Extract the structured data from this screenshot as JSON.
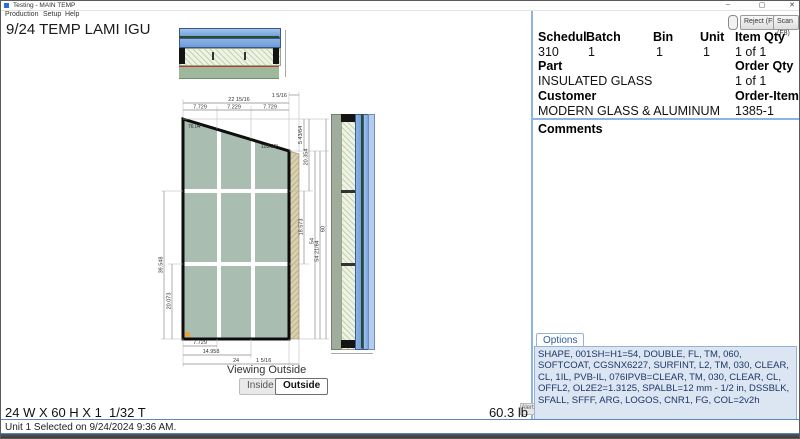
{
  "window": {
    "title": "Testing - MAIN TEMP",
    "minimize": "–",
    "maximize": "▢",
    "close": "✕"
  },
  "menu": {
    "items": [
      "Production",
      "Setup",
      "Help"
    ]
  },
  "toolbar": {
    "reject_label": "Reject (F5)",
    "scan_label": "Scan (F8)"
  },
  "drawing": {
    "title": "9/24 TEMP LAMI IGU",
    "viewing_label": "Viewing Outside",
    "inside_label": "Inside",
    "outside_label": "Outside",
    "angles": {
      "top_left": "76.04°",
      "top_right": "103.96°"
    },
    "dims": {
      "top_strip": "1 5/16",
      "top_total": "22 15/16",
      "top_seg1": "7.729",
      "top_seg2": "7.229",
      "top_seg3": "7.729",
      "right_drop": "5 43/64",
      "right_sec1": "20.354",
      "right_sec2": "18.573",
      "right_glass_height": "54",
      "right_edge_height": "54 21/64",
      "overall_height": "60",
      "left_span": "39.548",
      "left_bottom": "20.073",
      "bottom_seg": "7.729",
      "bottom_mid": "14.958",
      "bottom_total": "24",
      "bottom_strip": "1 5/16"
    }
  },
  "info": {
    "headers": {
      "schedule": "Schedul",
      "batch": "Batch",
      "bin": "Bin",
      "unit": "Unit",
      "item_qty": "Item Qty",
      "part": "Part",
      "order_qty": "Order Qty",
      "customer": "Customer",
      "order_item": "Order-Item"
    },
    "values": {
      "schedule": "310",
      "batch": "1",
      "bin": "1",
      "unit": "1",
      "item_qty": "1 of 1",
      "part": "INSULATED GLASS",
      "order_qty": "1 of 1",
      "customer": "MODERN GLASS & ALUMINUM",
      "order_item": "1385-1"
    }
  },
  "comments": {
    "label": "Comments"
  },
  "options": {
    "tab_label": "Options",
    "alerts_label": "Alerts",
    "text": "SHAPE, 001SH=H1=54, DOUBLE, FL, TM, 060, SOFTCOAT, CGSNX6227, SURFINT, L2, TM, 030, CLEAR, CL, 1IL, PVB-IL, 076IPVB=CLEAR, TM, 030, CLEAR, CL, OFFL2, OL2E2=1.3125, SPALBL=12 mm - 1/2 in, DSSBLK, SFALL, SFFF, ARG, LOGOS, CNR1, FG, COL=2v2h"
  },
  "status": {
    "size": "24 W X 60 H X 1  1/32 T",
    "weight": "60.3 lb",
    "message": "Unit 1 Selected on 9/24/2024 9:36 AM."
  },
  "colors": {
    "panel_divider": "#8eb4e3",
    "options_bg": "#dce6f2",
    "options_text": "#1c3667",
    "options_border": "#95b3d7",
    "glass_fill": "#a9bdb1",
    "glass_blue": "#7aa3dd",
    "lami_green": "#9fae9c",
    "edge_tan": "#d8d0b0",
    "corner_mark": "#e8a33d"
  }
}
